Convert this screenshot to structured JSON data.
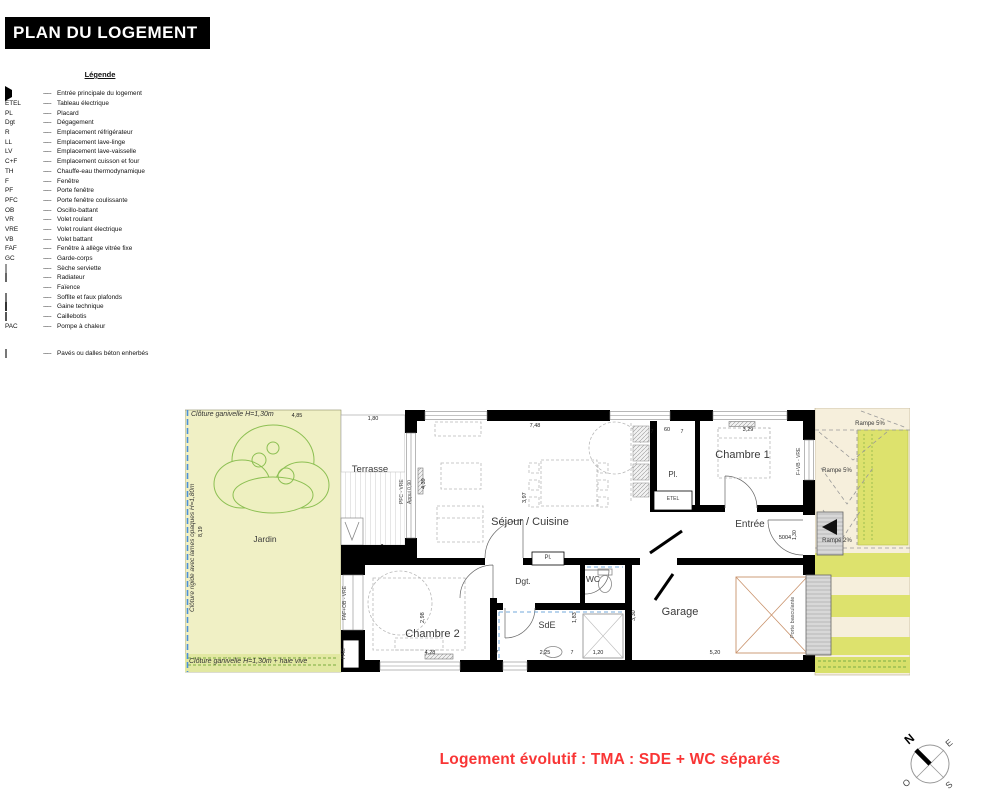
{
  "title": "PLAN DU LOGEMENT",
  "legend": {
    "header": "Légende",
    "dash": "-----",
    "items": [
      {
        "key": "",
        "desc": "Entrée principale du logement"
      },
      {
        "key": "ETEL",
        "desc": "Tableau électrique"
      },
      {
        "key": "PL",
        "desc": "Placard"
      },
      {
        "key": "Dgt",
        "desc": "Dégagement"
      },
      {
        "key": "R",
        "desc": "Emplacement réfrigérateur"
      },
      {
        "key": "LL",
        "desc": "Emplacement lave-linge"
      },
      {
        "key": "LV",
        "desc": "Emplacement lave-vaisselle"
      },
      {
        "key": "C+F",
        "desc": "Emplacement cuisson et four"
      },
      {
        "key": "TH",
        "desc": "Chauffe-eau thermodynamique"
      },
      {
        "key": "F",
        "desc": "Fenêtre"
      },
      {
        "key": "PF",
        "desc": "Porte fenêtre"
      },
      {
        "key": "PFC",
        "desc": "Porte fenêtre coulissante"
      },
      {
        "key": "OB",
        "desc": "Oscillo-battant"
      },
      {
        "key": "VR",
        "desc": "Volet roulant"
      },
      {
        "key": "VRE",
        "desc": "Volet roulant électrique"
      },
      {
        "key": "VB",
        "desc": "Volet battant"
      },
      {
        "key": "FAF",
        "desc": "Fenêtre à allège vitrée fixe"
      },
      {
        "key": "GC",
        "desc": "Garde-corps"
      },
      {
        "key": "",
        "desc": "Sèche serviette"
      },
      {
        "key": "",
        "desc": "Radiateur"
      },
      {
        "key": "",
        "desc": "Faïence"
      },
      {
        "key": "",
        "desc": "Soffite et faux plafonds"
      },
      {
        "key": "",
        "desc": "Gaine technique"
      },
      {
        "key": "",
        "desc": "Caillebotis"
      },
      {
        "key": "PAC",
        "desc": "Pompe à chaleur"
      },
      {
        "key": "",
        "desc": "Pavés ou dalles béton enherbés"
      }
    ]
  },
  "plan": {
    "rooms": {
      "terrasse": "Terrasse",
      "jardin": "Jardin",
      "sejour": "Séjour / Cuisine",
      "chambre1": "Chambre 1",
      "chambre2": "Chambre 2",
      "entree": "Entrée",
      "garage": "Garage",
      "dgt": "Dgt.",
      "wc": "WC",
      "sde": "SdE",
      "pl1": "Pl.",
      "pl2": "Pl.",
      "etel": "ETEL",
      "pac": "PAC"
    },
    "annotations": {
      "cloture_top": "Clôture ganivelle H=1,30m",
      "cloture_left": "Clôture rigide avec lames opaques H=1,80m",
      "cloture_bottom": "Clôture ganivelle H=1,30m + haie vive",
      "rampe5_a": "Rampe 5%",
      "rampe5_b": "Rampe 5%",
      "rampe2": "Rampé 2%",
      "porte_basculante": "Porte basculante",
      "door_number": "5004",
      "window_sejour": "PFC - VRE",
      "window_sill": "Appui 0,90",
      "window_ch1": "F+VB - VRE",
      "window_ch2": "FAF+OB - VRE"
    },
    "dims": {
      "jardin_w": "4,85",
      "terrasse_w": "1,80",
      "sejour_w": "7,48",
      "pl_left": "7",
      "pl_w": "60",
      "pl_right": "7",
      "ch1_w": "3,29",
      "sejour_h": "3,97",
      "window_h": "4,39",
      "jardin_h": "8,19",
      "ch2_w": "4,28",
      "ch2_h": "2,98",
      "sde_w": "2,25",
      "t1": "7",
      "wc_w": "1,20",
      "t2": "7",
      "sde_h": "1,83",
      "garage_h": "3,30",
      "garage_w": "5,20",
      "entry_h": "1,30"
    }
  },
  "compass": {
    "n": "N",
    "e": "E",
    "s": "S",
    "w": "O"
  },
  "footer": {
    "note": "Logement évolutif : TMA : SDE + WC séparés"
  },
  "colors": {
    "wall": "#000000",
    "jardin": "#f0f0c5",
    "lawn": "#dde26d",
    "driveway": "#f6efdc",
    "tree": "#8cbf52",
    "boundary_blue": "#4a90d9",
    "faience_blue": "#5b9bd5",
    "door_swing": "#c9926b",
    "garage_door": "#d8d8d8",
    "note_red": "#f93535"
  }
}
